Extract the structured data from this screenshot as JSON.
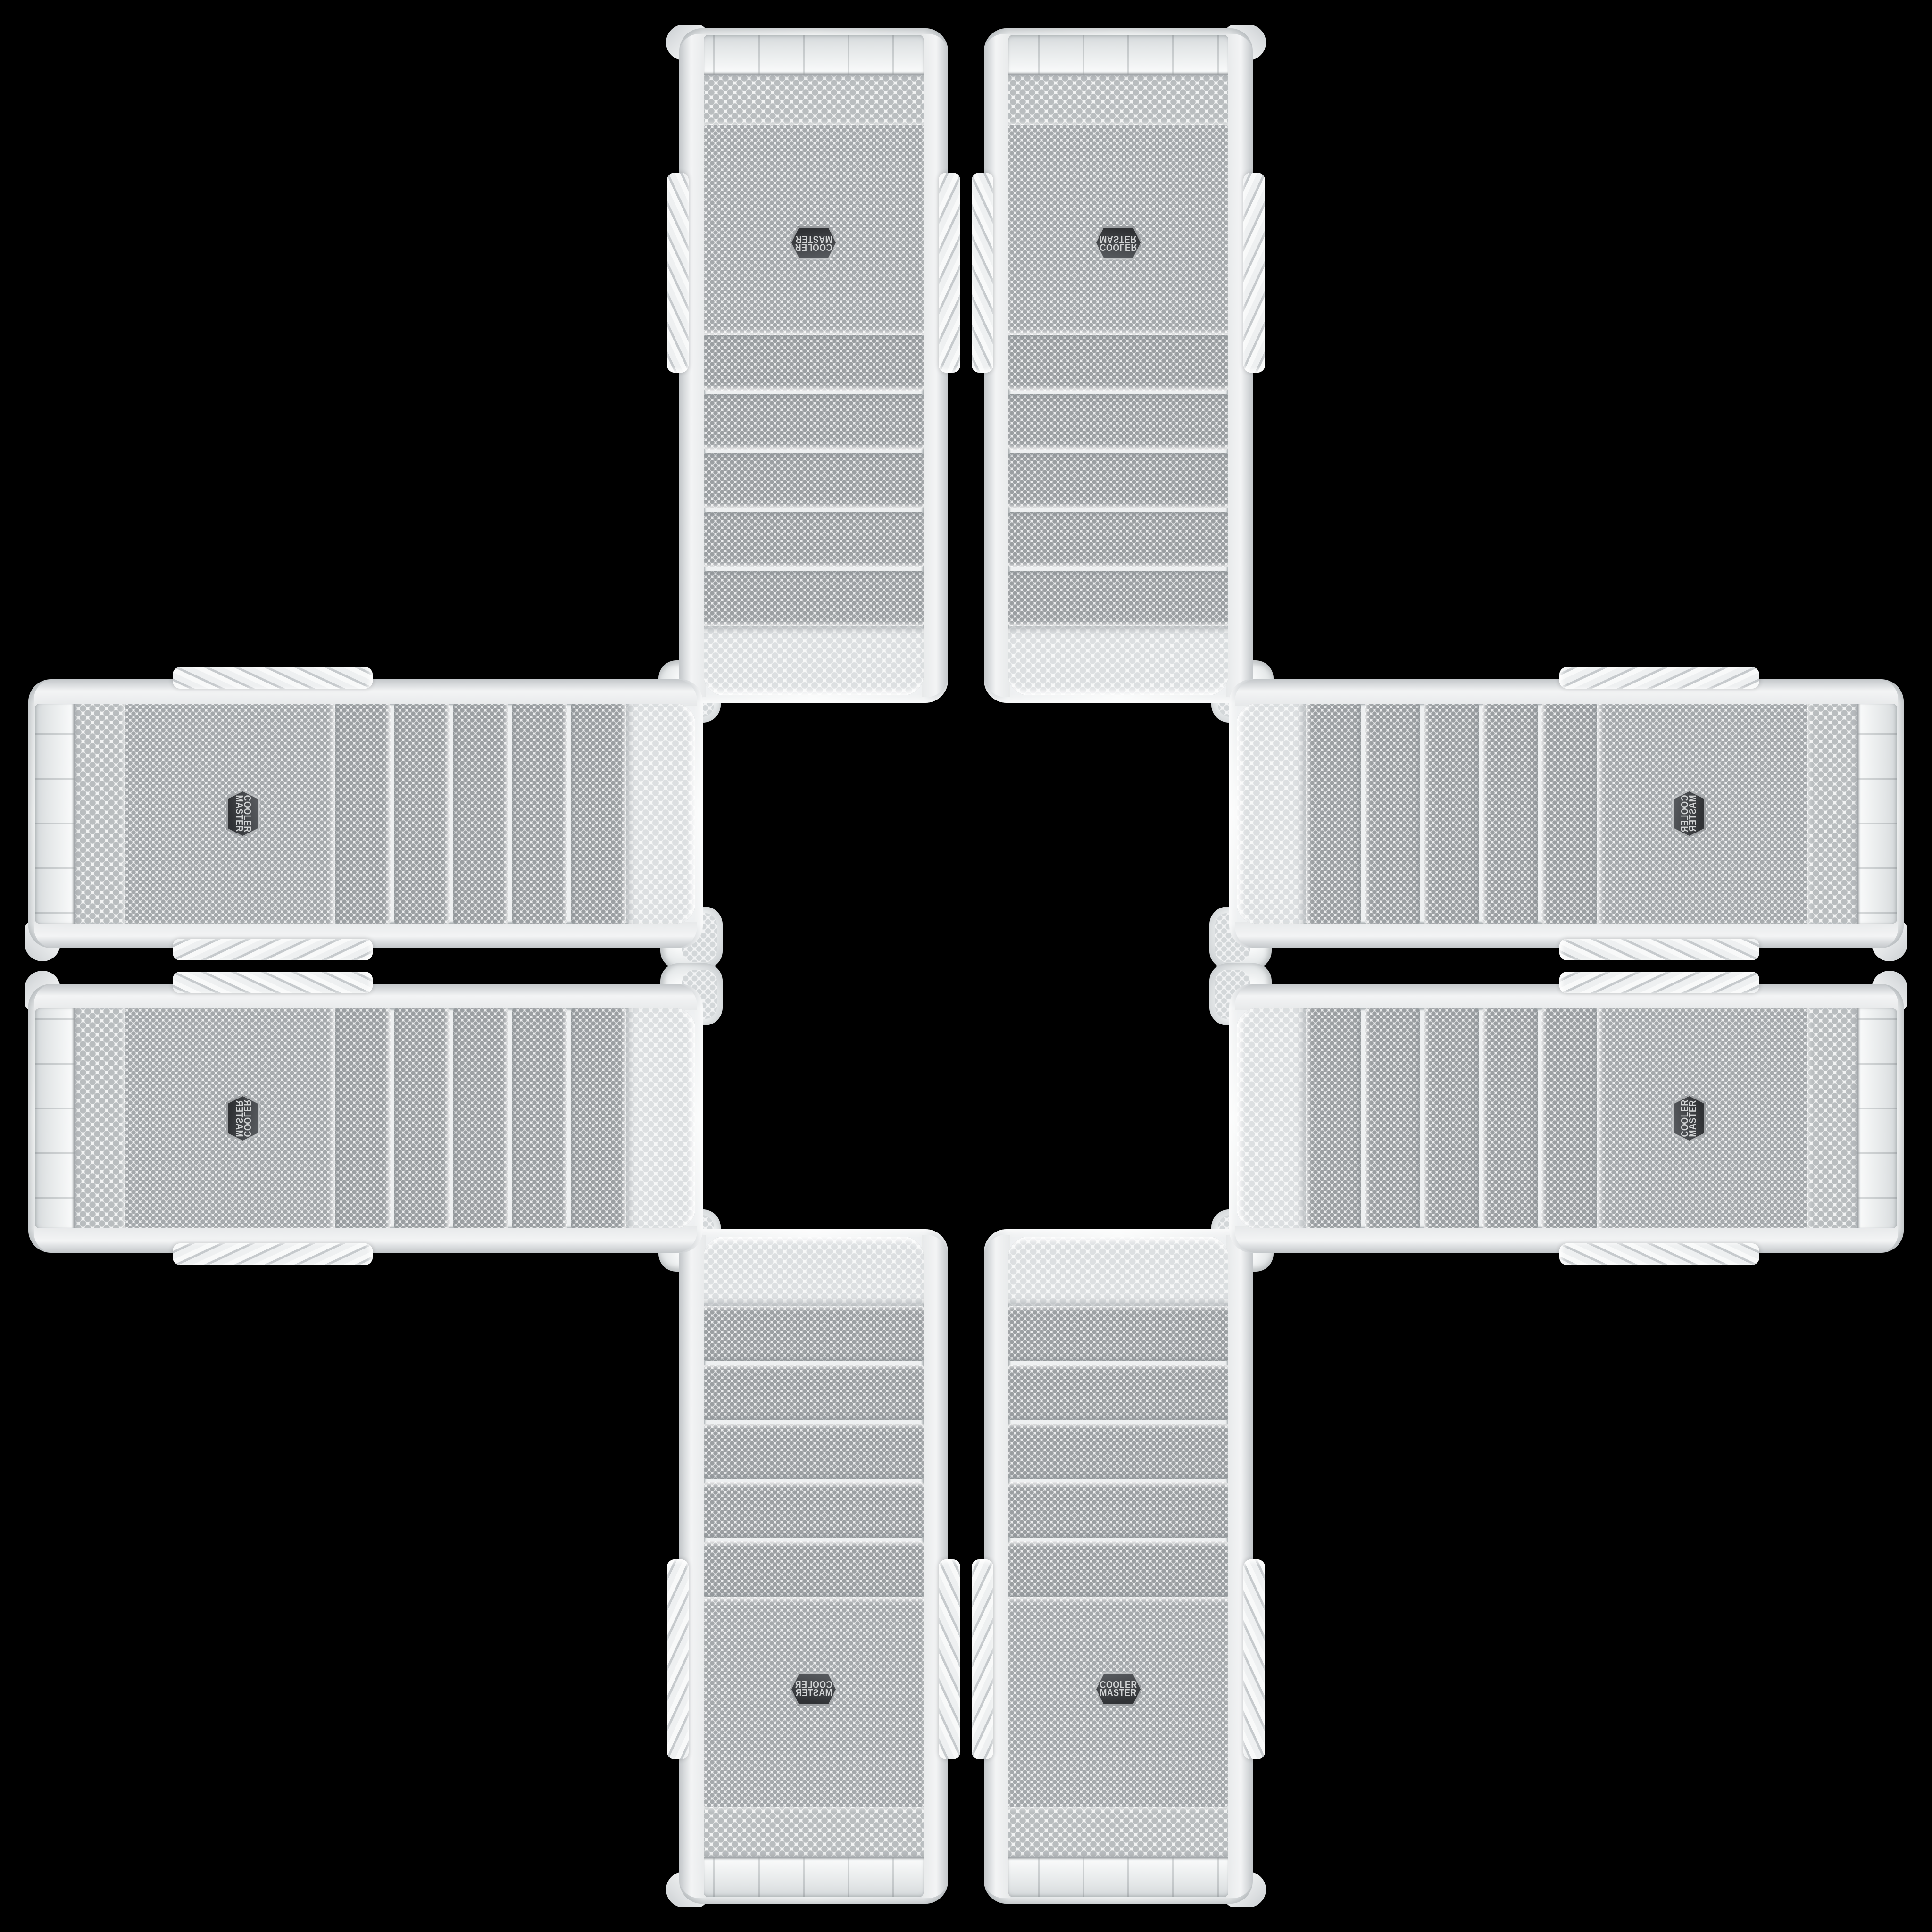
{
  "scene": {
    "type": "product-photo-collage",
    "description": "Eight identical white Cooler Master mid-tower PC cases arranged in a plus / cross pattern on a black background, mirrored across the horizontal and vertical center axes; the center of the cross is empty black",
    "background_color": "#000000",
    "total_cases": 8,
    "drive_bay_covers_per_case": 5,
    "brand_badge": {
      "line1": "COOLER",
      "line2": "MASTER",
      "shape": "hexagon",
      "badge_color": "#3a3c40",
      "badge_border_color": "#aeb1b3",
      "badge_text_color": "#d2d4d5"
    },
    "colors": {
      "case_shell": "#f4f5f6",
      "shell_shadow": "#c9cdd0",
      "mesh_background": "#eff0f1",
      "mesh_dot_fine": "#a4a8ab",
      "mesh_dot_bay": "#9b9fa2",
      "mesh_dot_coarse": "#dcdfe1",
      "chrome_trim": "#aeb3b6"
    },
    "cases": [
      {
        "id": "v-tl",
        "data_name": "pc-case-top-left",
        "orientation": "vertical",
        "quadrant": "top-left",
        "flip": "rotated-180"
      },
      {
        "id": "v-tr",
        "data_name": "pc-case-top-right",
        "orientation": "vertical",
        "quadrant": "top-right",
        "flip": "flipped-vertically"
      },
      {
        "id": "v-bl",
        "data_name": "pc-case-bottom-left",
        "orientation": "vertical",
        "quadrant": "bottom-left",
        "flip": "flipped-horizontally"
      },
      {
        "id": "v-br",
        "data_name": "pc-case-bottom-right",
        "orientation": "vertical",
        "quadrant": "bottom-right",
        "flip": "upright-original"
      },
      {
        "id": "h-lt",
        "data_name": "pc-case-left-top",
        "orientation": "horizontal",
        "quadrant": "left-top",
        "flip": "rotated-90-cw"
      },
      {
        "id": "h-lb",
        "data_name": "pc-case-left-bottom",
        "orientation": "horizontal",
        "quadrant": "left-bottom",
        "flip": "rotated-90-ccw-mirrored"
      },
      {
        "id": "h-rt",
        "data_name": "pc-case-right-top",
        "orientation": "horizontal",
        "quadrant": "right-top",
        "flip": "rotated-90-ccw-flipped"
      },
      {
        "id": "h-rb",
        "data_name": "pc-case-right-bottom",
        "orientation": "horizontal",
        "quadrant": "right-bottom",
        "flip": "rotated-90-ccw"
      }
    ]
  }
}
